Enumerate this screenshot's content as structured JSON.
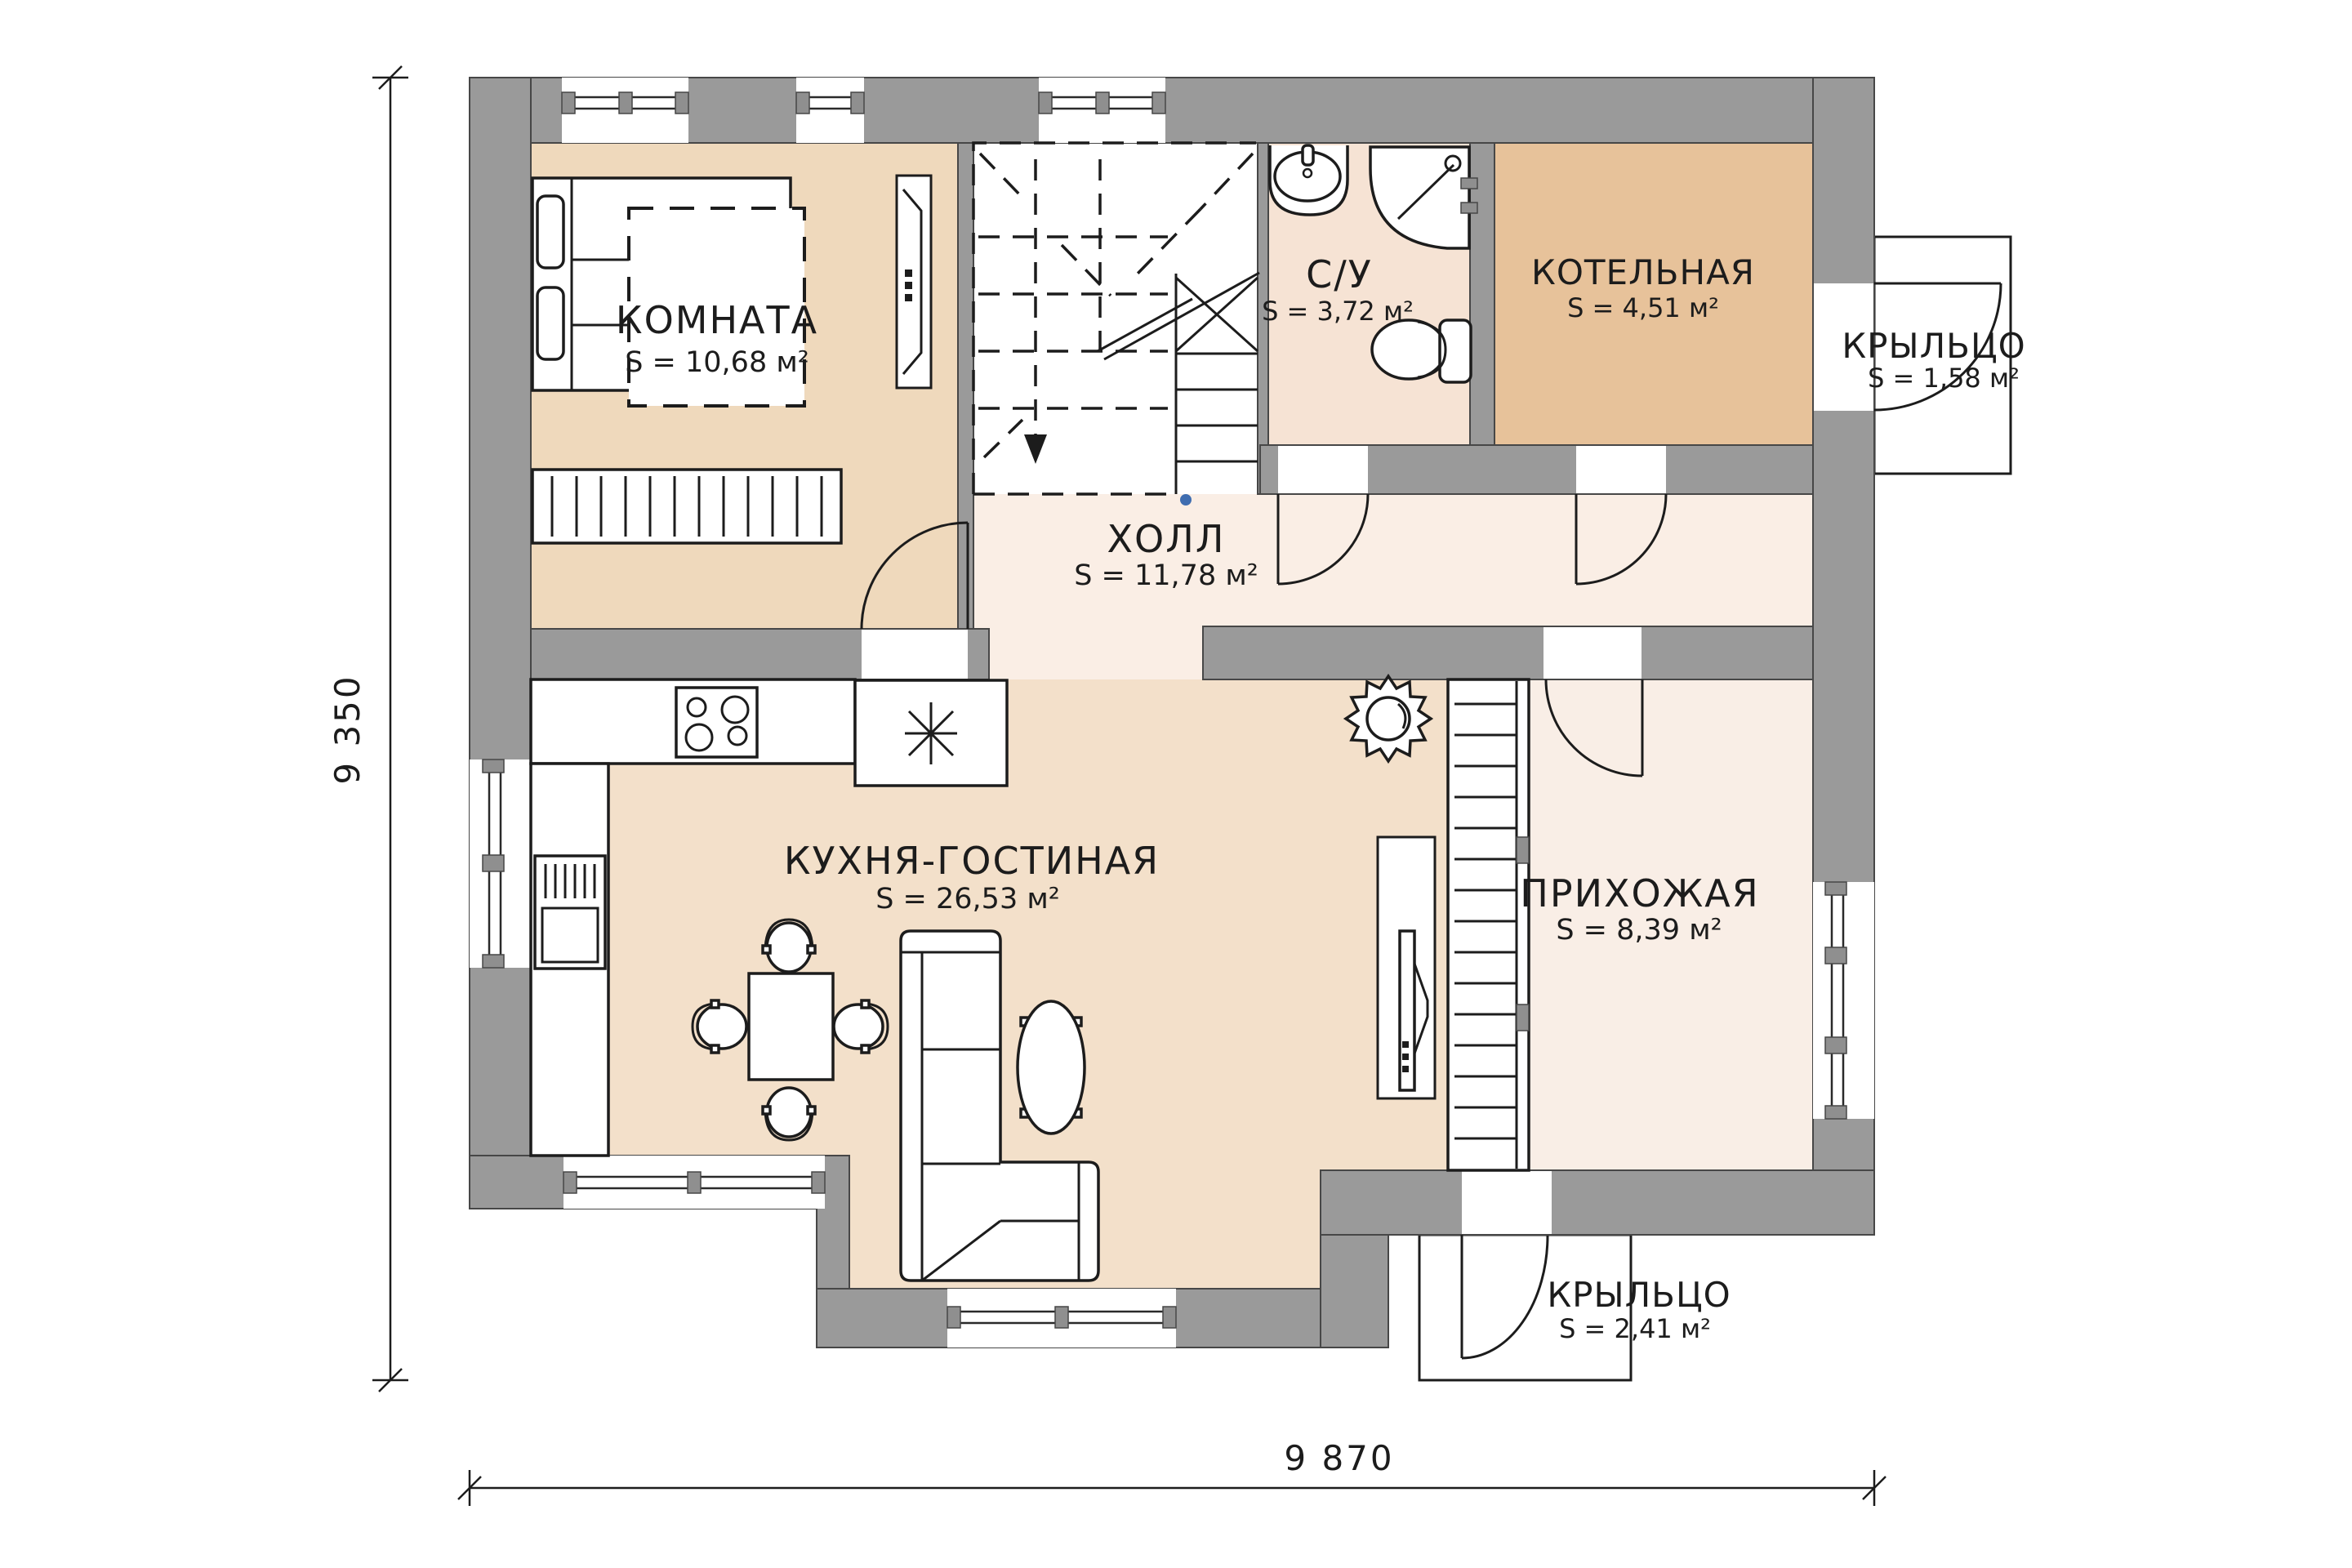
{
  "rooms": {
    "komnata": {
      "name": "КОМНАТА",
      "area": "S = 10,68 м²"
    },
    "su": {
      "name": "С/У",
      "area": "S = 3,72 м²"
    },
    "kotelnaya": {
      "name": "КОТЕЛЬНАЯ",
      "area": "S = 4,51 м²"
    },
    "kryltso_top": {
      "name": "КРЫЛЬЦО",
      "area": "S = 1,58 м²"
    },
    "holl": {
      "name": "ХОЛЛ",
      "area": "S = 11,78 м²"
    },
    "kuhnya_gostinaya": {
      "name": "КУХНЯ-ГОСТИНАЯ",
      "area": "S = 26,53 м²"
    },
    "prihozhaya": {
      "name": "ПРИХОЖАЯ",
      "area": "S = 8,39 м²"
    },
    "kryltso_bottom": {
      "name": "КРЫЛЬЦО",
      "area": "S = 2,41 м²"
    }
  },
  "dimensions": {
    "vertical": "9 350",
    "horizontal": "9 870"
  },
  "colors": {
    "wall": "#9a9a9a",
    "floor_komnata": "#efd9bc",
    "floor_su": "#f6e3d4",
    "floor_kotelnaya": "#e7c29a",
    "floor_holl": "#faeee5",
    "floor_kuhnya": "#f3e0ca",
    "floor_prihozhaya": "#f9eee6",
    "stair_marker": "#3f6db0"
  }
}
